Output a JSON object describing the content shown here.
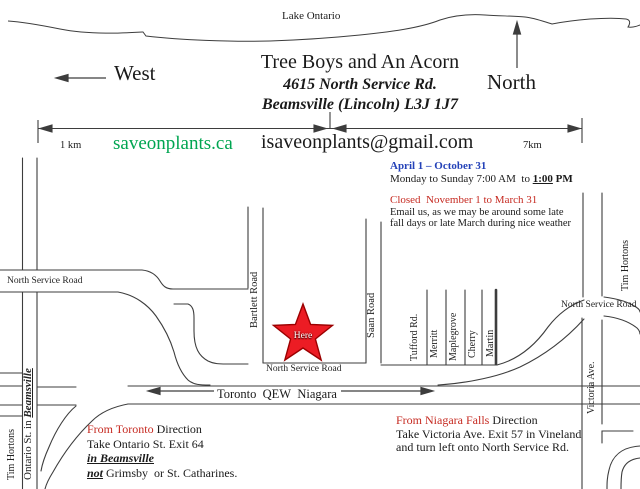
{
  "colors": {
    "website_green": "#00A551",
    "season_blue": "#2442B8",
    "alert_red": "#C62A21",
    "star_red": "#EC1C24",
    "star_edge": "#9B0000",
    "road_gray": "#3d3d3d"
  },
  "header": {
    "lake_label": "Lake Ontario",
    "west_label": "West",
    "north_label": "North",
    "title": "Tree Boys and An Acorn",
    "address": "4615 North Service Rd.",
    "city": "Beamsville (Lincoln) L3J 1J7"
  },
  "scale": {
    "left_value": "1 km",
    "right_value": "7km",
    "website": "saveonplants.ca",
    "email": "isaveonplants@gmail.com"
  },
  "hours": {
    "season_open": "April 1 – October 31",
    "open_prefix": "Monday to Sunday 7:00 AM  to ",
    "open_time": "1:00",
    "open_ampm": " PM",
    "season_closed": "Closed   November 1 to March 31",
    "closed_note1": "Email us, as we may be around some late",
    "closed_note2": "fall days or late March during nice weather"
  },
  "map": {
    "nsr_west": "North Service Road",
    "nsr_center": "North Service Road",
    "nsr_east": "North Service Road",
    "ontario_prefix": "Ontario St. in ",
    "ontario_city": "Beamsville",
    "bartlett": "Bartlett Road",
    "saan": "Saan Road",
    "side_streets": [
      "Tufford Rd.",
      "Merritt",
      "Maplegrove",
      "Cherry",
      "Martin"
    ],
    "tim_hortons_left": "Tim Hortons",
    "tim_hortons_right": "Tim Hortons",
    "victoria": "Victoria Ave.",
    "here_label": "Here",
    "qew_label": "Toronto   QEW   Niagara"
  },
  "directions": {
    "toronto": {
      "from_red": "From Toronto",
      "from_rest": " Direction",
      "line2": "Take Ontario St. Exit 64",
      "line3": "in Beamsville",
      "line4_bold": "not",
      "line4_rest": " Grimsby  or St. Catharines."
    },
    "niagara": {
      "from_red": "From Niagara Falls",
      "from_rest": " Direction",
      "line2": "Take Victoria Ave. Exit 57 in Vineland",
      "line3": "and turn left onto North Service Rd."
    }
  }
}
